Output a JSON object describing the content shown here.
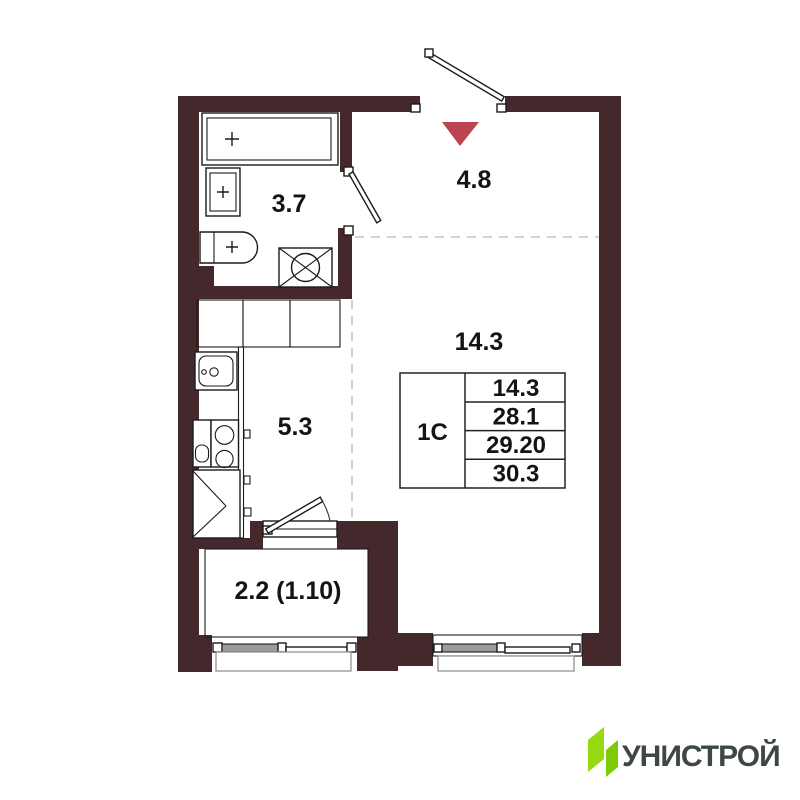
{
  "floor_plan": {
    "wall_color": "#45282b",
    "entrance_marker_color": "#bc4350",
    "dashed_line_color": "#cbcbcb",
    "rooms": {
      "bathroom": {
        "area": "3.7"
      },
      "hallway": {
        "area": "4.8"
      },
      "living": {
        "area": "14.3"
      },
      "kitchen": {
        "area": "5.3"
      },
      "balcony": {
        "area": "2.2 (1.10)"
      }
    },
    "info_table": {
      "type": "1С",
      "values": [
        "14.3",
        "28.1",
        "29.20",
        "30.3"
      ]
    }
  },
  "logo": {
    "text": "УНИСТРОЙ",
    "green_primary": "#94d911",
    "green_secondary": "#7dcb02",
    "text_color": "#3d4744"
  }
}
